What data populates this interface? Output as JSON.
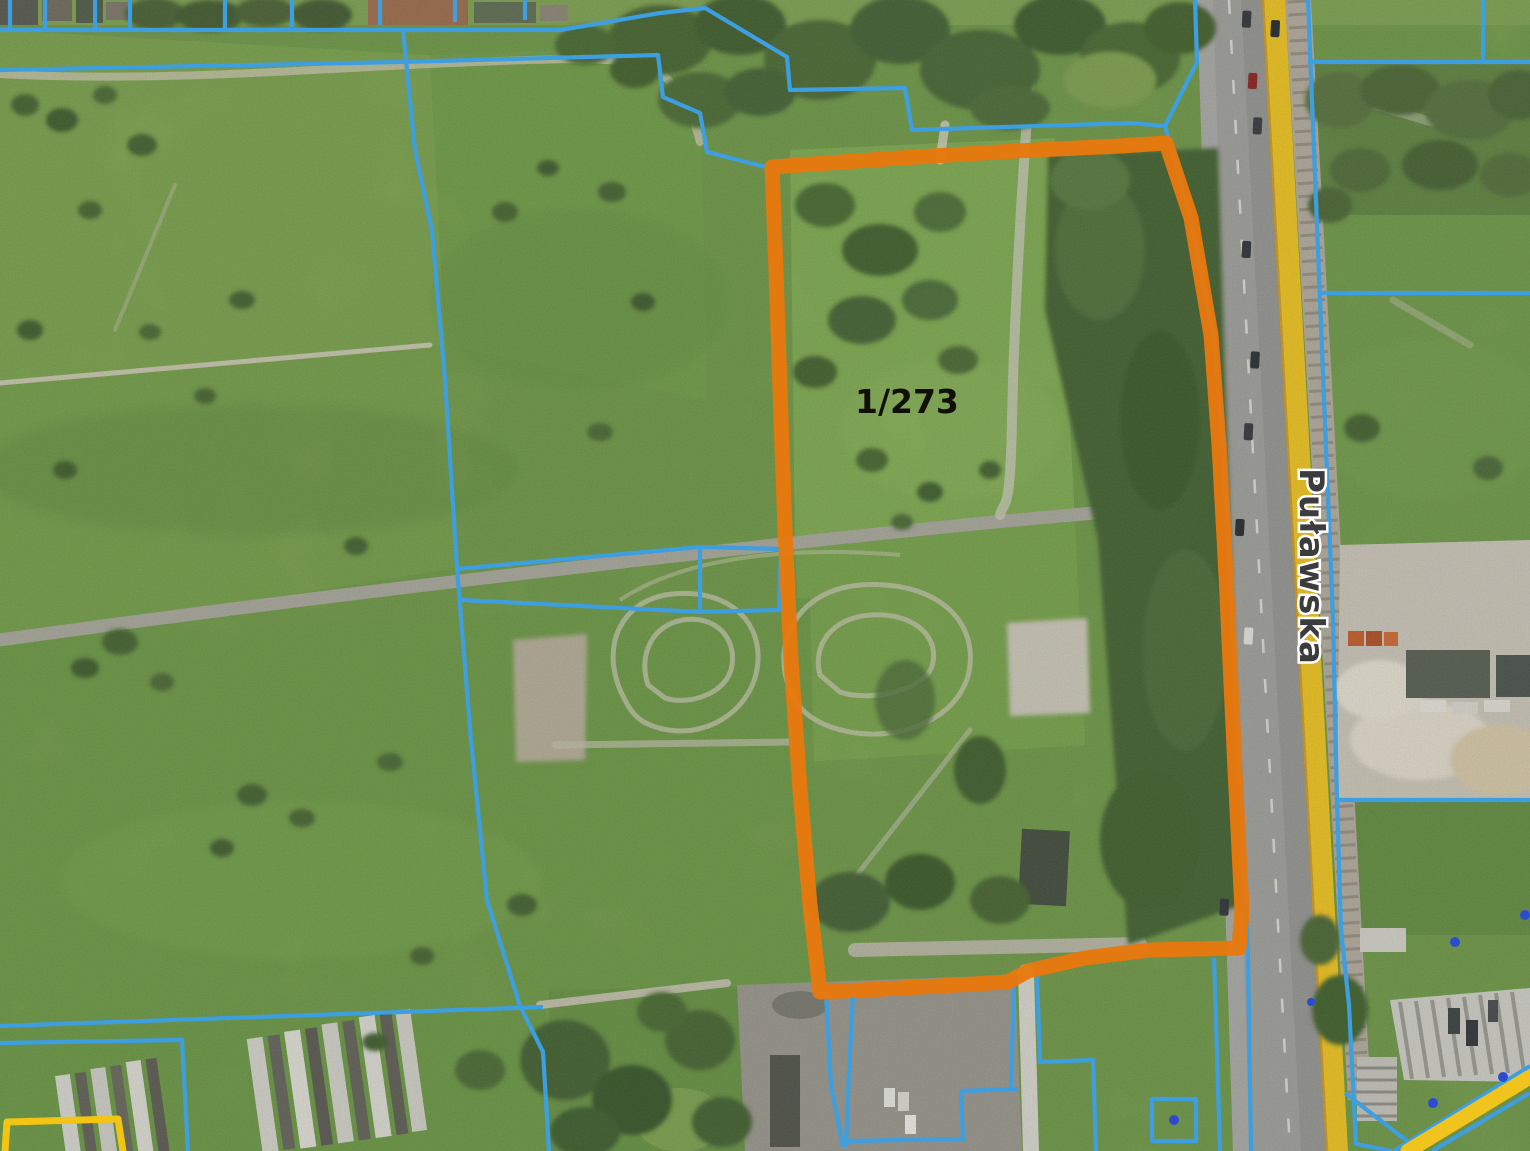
{
  "map": {
    "type": "aerial-cadastral-view",
    "parcel": {
      "label": "1/273"
    },
    "street": {
      "label": "Puławska"
    },
    "colors": {
      "selected_parcel_outline": "#E8790E",
      "cadastral_line": "#3D9EE0",
      "road_edge_yellow": "#F0C41C",
      "special_boundary_yellow": "#F2C414",
      "survey_point_blue": "#2B4BD0"
    }
  }
}
